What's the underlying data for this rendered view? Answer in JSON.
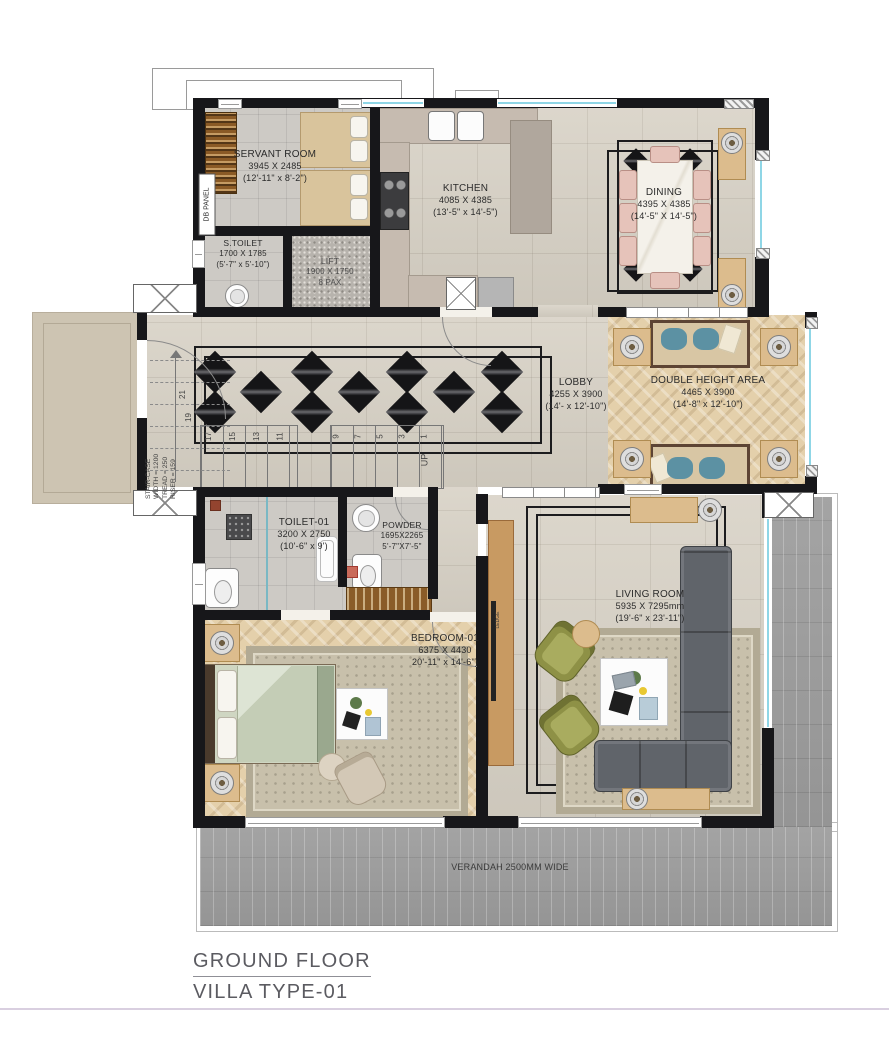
{
  "palette": {
    "wall": "#17171a",
    "window_glass": "#8fd6e6",
    "floor_marble": "#d8d2c6",
    "floor_wood": "#e4d0ab",
    "verandah_gray": "#8f8f8f",
    "wood_furniture": "#dcbc8d",
    "sofa_gray": "#60646a",
    "armchair_olive": "#8e9146",
    "cushion_blue": "#5c91a3",
    "chair_pink": "#e6c3ba",
    "title_text": "#5b5b61"
  },
  "rooms": {
    "servant": {
      "name": "SERVANT ROOM",
      "mm": "3945 X 2485",
      "ft": "(12'-11\" x 8'-2\")"
    },
    "s_toilet": {
      "name": "S.TOILET",
      "mm": "1700 X 1785",
      "ft": "(5'-7\" x 5'-10\")"
    },
    "lift": {
      "name": "LIFT",
      "mm": "1900 X 1750",
      "pax": "8 PAX"
    },
    "kitchen": {
      "name": "KITCHEN",
      "mm": "4085 X 4385",
      "ft": "(13'-5\" x 14'-5\")"
    },
    "dining": {
      "name": "DINING",
      "mm": "4395 X 4385",
      "ft": "(14'-5\" X 14'-5\")"
    },
    "lobby": {
      "name": "LOBBY",
      "mm": "4255 X 3900",
      "ft": "(14'- x 12'-10\")"
    },
    "double_height": {
      "name": "DOUBLE HEIGHT AREA",
      "mm": "4465 X 3900",
      "ft": "(14'-8\" x 12'-10\")"
    },
    "toilet1": {
      "name": "TOILET-01",
      "mm": "3200 X 2750",
      "ft": "(10'-6\" x 9')"
    },
    "powder": {
      "name": "POWDER",
      "mm": "1695X2265",
      "ft": "5'-7\"X7'-5\""
    },
    "bedroom1": {
      "name": "BEDROOM-01",
      "mm": "6375 X 4430",
      "ft": "20'-11\" x 14'-6\")"
    },
    "living": {
      "name": "LIVING ROOM",
      "mm": "5935 X 7295mm",
      "ft": "(19'-6\" x 23'-11\")"
    },
    "verandah": {
      "name": "VERANDAH 2500MM WIDE"
    }
  },
  "stairs": {
    "spec": [
      "STAIR-CASE",
      "WIDTH = 1200",
      "TREAD = 250",
      "RISER = 159"
    ],
    "treads": [
      "17",
      "15",
      "13",
      "11",
      "9",
      "7",
      "5",
      "3",
      "1"
    ],
    "upper": [
      "21",
      "19"
    ],
    "up": "UP"
  },
  "labels": {
    "db_panel": "DB PANEL",
    "ledge": "LEDGE"
  },
  "footer": {
    "line1": "GROUND FLOOR",
    "line2": "VILLA TYPE-01"
  }
}
